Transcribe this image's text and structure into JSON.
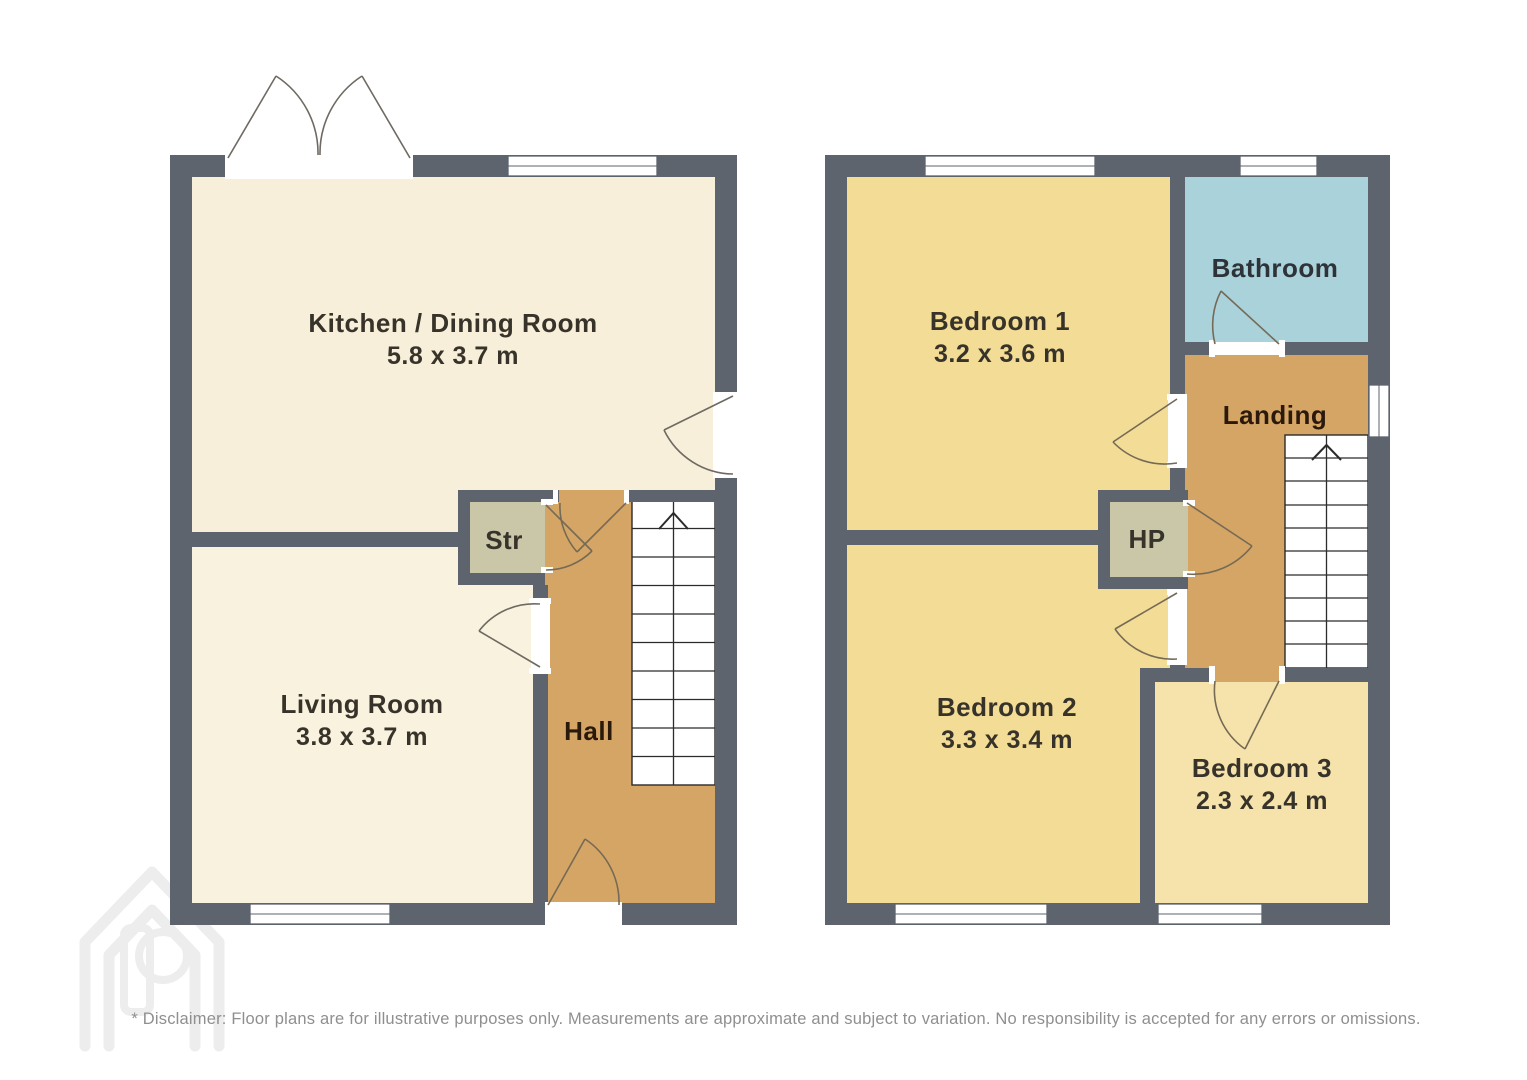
{
  "floorplan": {
    "colors": {
      "wall": "#5d646d",
      "kitchen": "#f7efd9",
      "living": "#f8f2de",
      "hall": "#d5a565",
      "storage": "#c9c7a8",
      "bathroom": "#aad2da",
      "landing": "#d5a565",
      "hp": "#c9c7a8",
      "bedroom1": "#f3dc96",
      "bedroom2": "#f3dc96",
      "bedroom3": "#f5e3ab",
      "stairs": "#ffffff"
    },
    "ground_floor": {
      "rooms": [
        {
          "name": "Kitchen / Dining Room",
          "dimensions": "5.8 x 3.7 m"
        },
        {
          "name": "Living Room",
          "dimensions": "3.8 x 3.7 m"
        },
        {
          "name": "Str"
        },
        {
          "name": "Hall"
        }
      ],
      "stairs_direction": "up"
    },
    "first_floor": {
      "rooms": [
        {
          "name": "Bedroom 1",
          "dimensions": "3.2 x 3.6 m"
        },
        {
          "name": "Bathroom"
        },
        {
          "name": "Landing"
        },
        {
          "name": "HP"
        },
        {
          "name": "Bedroom 2",
          "dimensions": "3.3 x 3.4 m"
        },
        {
          "name": "Bedroom 3",
          "dimensions": "2.3 x 2.4 m"
        }
      ],
      "stairs_direction": "up"
    },
    "watermark": {
      "icon": "house-p-logo"
    },
    "disclaimer": "* Disclaimer: Floor plans are for illustrative purposes only. Measurements are approximate and subject to variation. No responsibility is accepted for any errors or omissions."
  }
}
